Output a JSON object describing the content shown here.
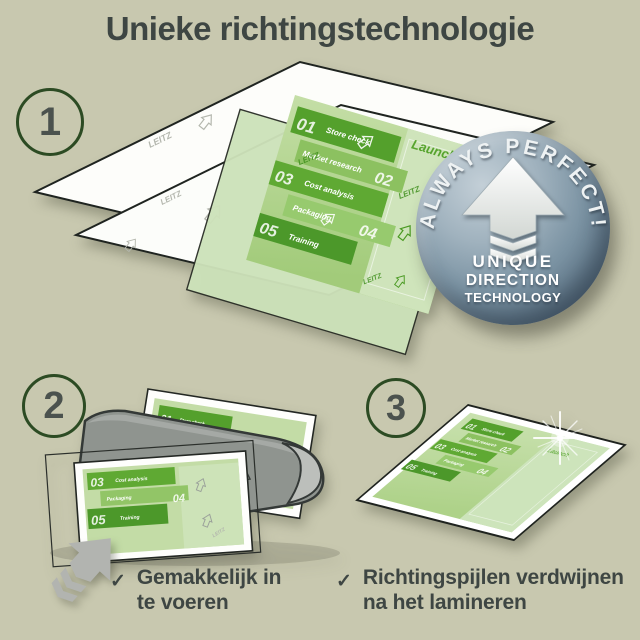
{
  "title": "Unieke richtingstechnologie",
  "steps": [
    {
      "number": "1"
    },
    {
      "number": "2"
    },
    {
      "number": "3"
    }
  ],
  "badge": {
    "arc": "ALWAYS PERFECT!",
    "line1": "UNIQUE",
    "line2": "DIRECTION",
    "line3": "TECHNOLOGY"
  },
  "document": {
    "watermark": "LEITZ",
    "side_label": "Launch",
    "bands": [
      {
        "num": "01",
        "label": "Store check"
      },
      {
        "num": "02",
        "label": "Market research"
      },
      {
        "num": "03",
        "label": "Cost analysis"
      },
      {
        "num": "04",
        "label": "Packaging"
      },
      {
        "num": "05",
        "label": "Training"
      }
    ]
  },
  "checklist": [
    {
      "mark": "✓",
      "line1": "Gemakkelijk in",
      "line2": "te voeren"
    },
    {
      "mark": "✓",
      "line1": "Richtingspijlen verdwijnen",
      "line2": "na het lamineren"
    }
  ],
  "colors": {
    "background": "#c8c8af",
    "text": "#3e4643",
    "green_dark": "#4f9a2b",
    "green_mid": "#8cc160",
    "green_light": "#c6dfad",
    "badge_steel": "#7b93a3",
    "circle_outline": "#2c4b23",
    "machine_gray": "#8f948f"
  }
}
